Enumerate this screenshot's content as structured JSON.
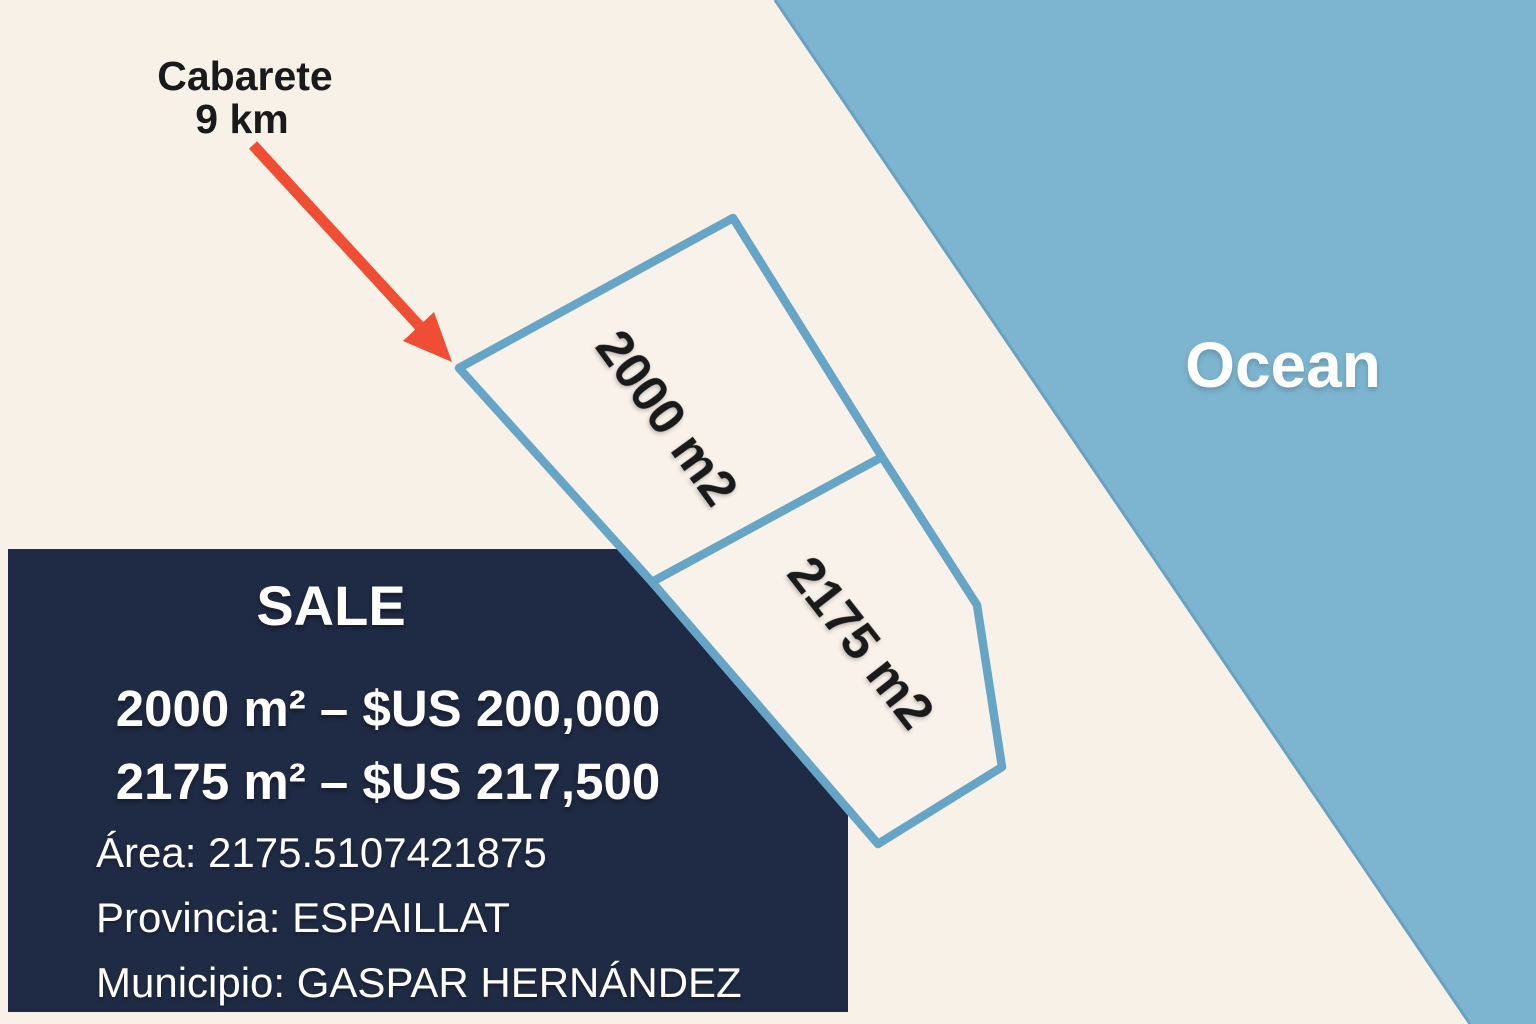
{
  "colors": {
    "background": "#f8f1e8",
    "ocean": "#7db5d1",
    "coastline": "#68a2c2",
    "plot-outline": "#67a5c6",
    "plot-fill": "#f9f2ea",
    "box-bg": "#1f2a44",
    "arrow": "#ef4e35",
    "dark-text": "#1a1a1a",
    "light-text": "#ffffff"
  },
  "map": {
    "ocean_label": "Ocean",
    "arrow_label": {
      "line1": "Cabarete",
      "line2": "9 km"
    },
    "parcels": [
      {
        "label": "2000 m2"
      },
      {
        "label": "2175 m2"
      }
    ]
  },
  "sale_box": {
    "title": "SALE",
    "prices": [
      "2000 m² – $US 200,000",
      "2175 m² – $US 217,500"
    ],
    "details": [
      "Área: 2175.5107421875",
      "Provincia: ESPAILLAT",
      "Municipio: GASPAR HERNÁNDEZ"
    ]
  }
}
